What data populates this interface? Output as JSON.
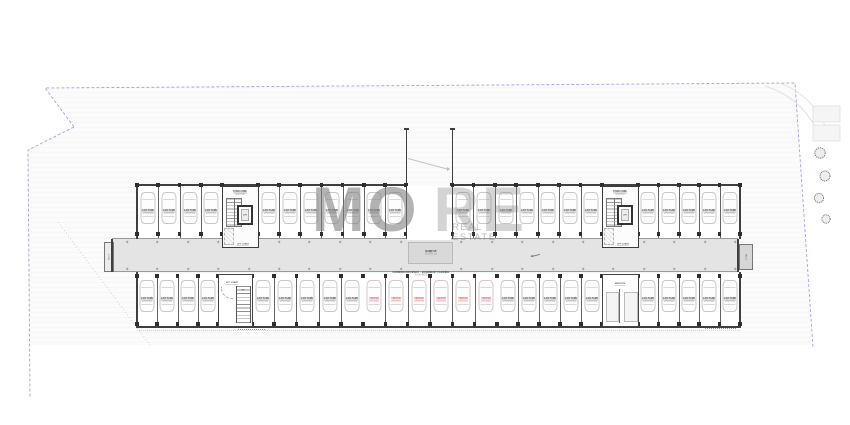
{
  "watermark": {
    "part1": "MO",
    "part2": "RE",
    "line2": "REAL ESTATE"
  },
  "site": {
    "boundary_color": "#8a8ad8",
    "boundary_style": "dashed property line with notched left edge",
    "trees_right_side": 4
  },
  "building": {
    "type": "basement car-parking floor plan",
    "stall_counts": {
      "top_row": 23,
      "bottom_row": 25,
      "visitor_red_stalls": 6
    },
    "colors": {
      "wall": "#3f3f3f",
      "divider": "#636363",
      "corridor_fill": "#e4e4e5",
      "landing_fill": "#d9d9d9",
      "car_outline": "#c8c8c8",
      "label_dark": "#3a3a3a",
      "label_grey": "#8a8a8a",
      "visitor_red": "#cf4f4f"
    },
    "labels": {
      "stall_title": "CAR PARK",
      "stall_dim": "2.5 X 5.0",
      "visitor_title": "VISITOR",
      "visitor_dim": "2.5 X 5.0",
      "stair_core_title": "STAIR CORE",
      "stair_core_dim": "3.4 X 5.6",
      "lift": "LIFT",
      "lift_lobby": "LIFT LOBBY",
      "stair_down": "DN",
      "service_room": "SERVICES",
      "ramp_landing_line1": "RAMP UP",
      "ramp_landing_line2": "SLOPE 1:8",
      "driveway_line1": "COMMON DRIVEWAY - BASEMENT PARKING",
      "driveway_line2": "6.0 M WIDE",
      "duct": "DUCT"
    }
  }
}
